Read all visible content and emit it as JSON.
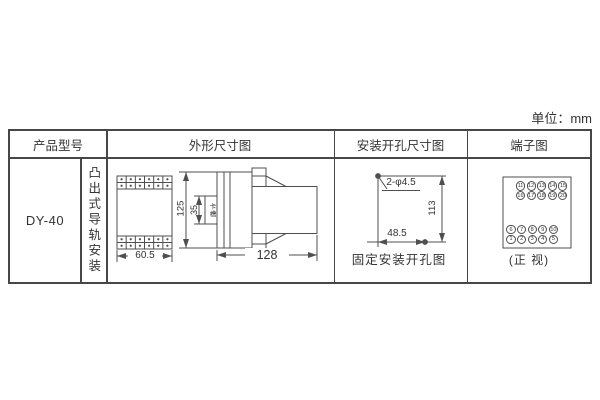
{
  "unit_label": "单位：mm",
  "table": {
    "headers": {
      "product_model": "产品型号",
      "outline": "外形尺寸图",
      "mounting_hole": "安装开孔尺寸图",
      "terminal": "端子图"
    },
    "product_model": "DY-40",
    "mounting_style": "凸出式导轨安装"
  },
  "outline_drawing": {
    "front_width": "60.5",
    "total_height": "125",
    "slot_height": "35",
    "slot_label": "卡槽",
    "depth": "128"
  },
  "mounting_drawing": {
    "holes": "2-φ4.5",
    "vertical_distance": "113",
    "horizontal_distance": "48.5",
    "caption": "固定安装开孔图"
  },
  "terminal_diagram": {
    "top_rows": [
      [
        "11",
        "12",
        "13",
        "14",
        "15"
      ],
      [
        "16",
        "17",
        "18",
        "19",
        "20"
      ]
    ],
    "bottom_rows": [
      [
        "6",
        "7",
        "8",
        "9",
        "10"
      ],
      [
        "1",
        "2",
        "3",
        "4",
        "5"
      ]
    ],
    "caption": "(正 视)"
  },
  "colors": {
    "table_border": "#474747",
    "drawing_line": "#4f4f4f",
    "text": "#333333",
    "background": "#ffffff"
  }
}
